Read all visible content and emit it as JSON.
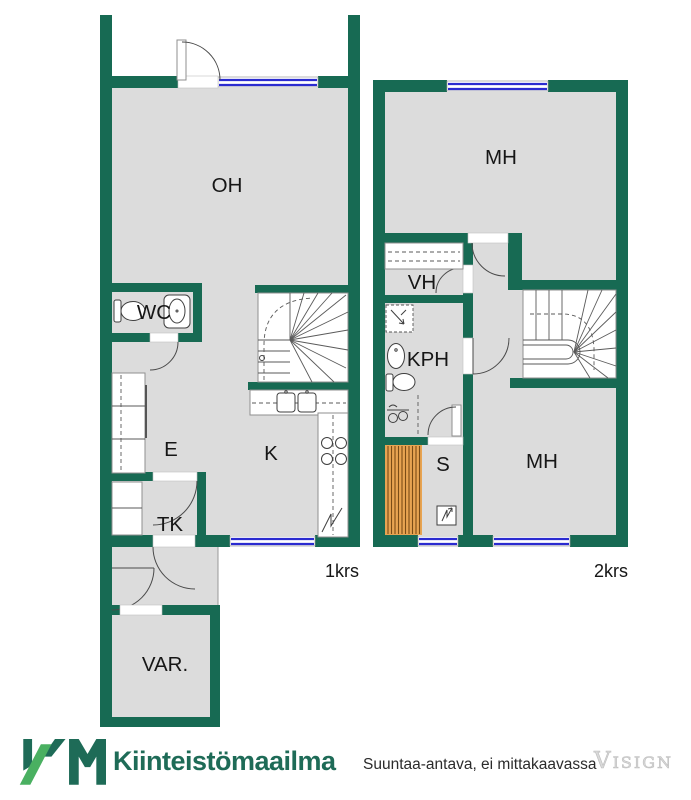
{
  "floor1": {
    "floor_label": "1krs",
    "rooms": {
      "oh": "OH",
      "wc": "WC",
      "e": "E",
      "k": "K",
      "tk": "TK",
      "var": "VAR."
    }
  },
  "floor2": {
    "floor_label": "2krs",
    "rooms": {
      "mh_top": "MH",
      "vh": "VH",
      "kph": "KPH",
      "s": "S",
      "mh_bottom": "MH"
    }
  },
  "footer": {
    "logo_initials": "KM",
    "brand": "Kiinteistömaailma",
    "disclaimer": "Suuntaa-antava, ei mittakaavassa",
    "watermark": "Visign"
  },
  "colors": {
    "wall": "#176a53",
    "floor": "#dcdcdc",
    "window": "#2b2bd0",
    "sauna_bench": "#e8a452",
    "sauna_stripe": "#7a4c16",
    "logo_dark": "#1e6b57",
    "logo_light": "#4ab061",
    "label": "#161616",
    "watermark": "#d9d9d9"
  }
}
